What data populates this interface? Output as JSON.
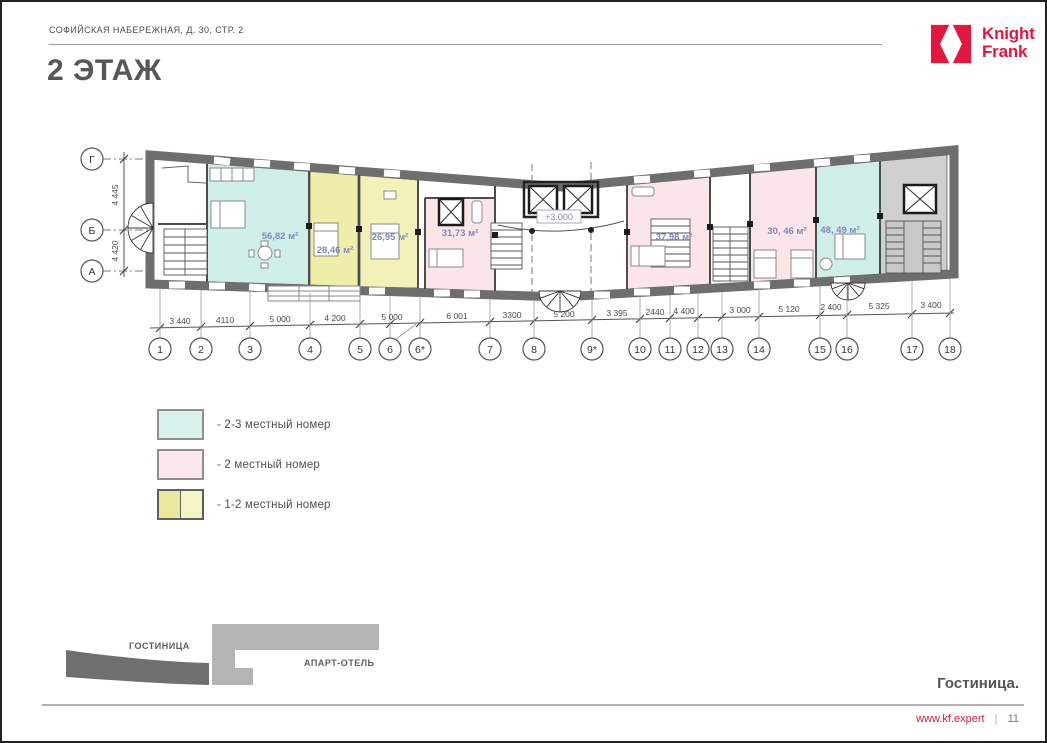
{
  "header": {
    "address": "СОФИЙСКАЯ НАБЕРЕЖНАЯ, Д. 30, СТР. 2",
    "title": "2 ЭТАЖ"
  },
  "logo": {
    "line1": "Knight",
    "line2": "Frank",
    "color": "#e2163f"
  },
  "plan": {
    "level_mark": "+3.000",
    "row_axes": [
      "Г",
      "Б",
      "А"
    ],
    "row_dims": [
      "4 445",
      "4 420"
    ],
    "col_axes": [
      "1",
      "2",
      "3",
      "4",
      "5",
      "6",
      "6*",
      "7",
      "8",
      "9*",
      "10",
      "11",
      "12",
      "13",
      "14",
      "15",
      "16",
      "17",
      "18"
    ],
    "col_dims": [
      "3 440",
      "4110",
      "5 000",
      "4 200",
      "5 000",
      "6 001",
      "3300",
      "5 200",
      "3 395",
      "2440",
      "4 400",
      "3 000",
      "5 120",
      "2 400",
      "5 325",
      "3 400"
    ],
    "rooms": [
      {
        "area": "56,82 м²",
        "category": "2-3 местный номер"
      },
      {
        "area": "28,46 м²",
        "category": "1-2 местный номер"
      },
      {
        "area": "26,95 м²",
        "category": "1-2 местный номер"
      },
      {
        "area": "31,73 м²",
        "category": "2 местный номер"
      },
      {
        "area": "37,98 м²",
        "category": "2 местный номер"
      },
      {
        "area": "30, 46 м²",
        "category": "2 местный номер"
      },
      {
        "area": "48, 49 м²",
        "category": "2-3 местный номер"
      }
    ]
  },
  "legend": {
    "items": [
      {
        "label": "- 2-3 местный номер",
        "color": "#d8f1ea"
      },
      {
        "label": "- 2 местный номер",
        "color": "#fce7ea"
      },
      {
        "label": "- 1-2 местный номер",
        "color": "#e9e89c",
        "color2": "#f6f5c6"
      }
    ]
  },
  "site_diagram": {
    "hotel": "ГОСТИНИЦА",
    "apart_hotel": "АПАРТ-ОТЕЛЬ"
  },
  "section_label": "Гостиница.",
  "footer": {
    "url": "www.kf.expert",
    "separator": "|",
    "page_number": "11"
  },
  "colors": {
    "accent_red": "#e2163f",
    "room_2_3": "#cfeee7",
    "room_2": "#fbe5e8",
    "room_1_2": "#f0efb4",
    "wall_gray": "#6e6e6e"
  }
}
